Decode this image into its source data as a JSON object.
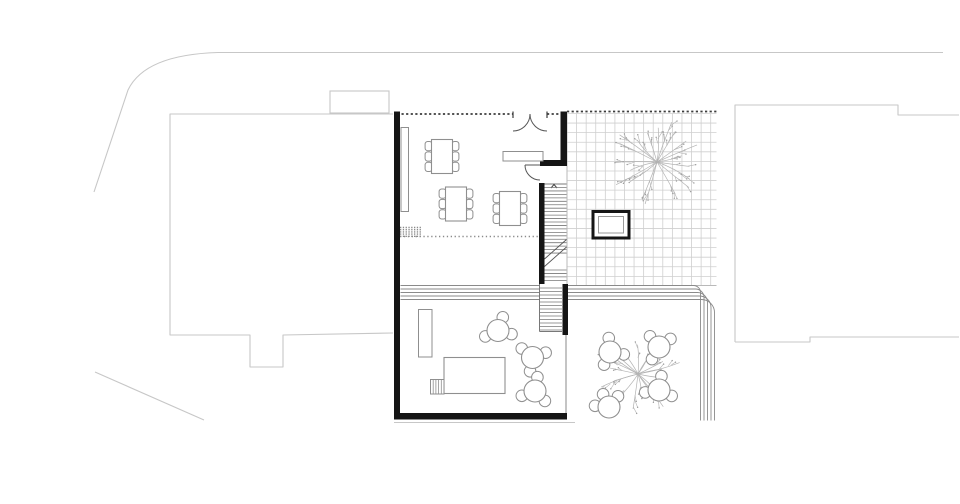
{
  "canvas": {
    "width": 960,
    "height": 504,
    "background": "#ffffff"
  },
  "colors": {
    "wall": "#151515",
    "site": "#c7c7c7",
    "grid": "#cfcfcf",
    "furniture": "#8f8f8f",
    "stair": "#787878",
    "dash_dark": "#3c3c3c",
    "dots": "#8a8a8a",
    "tree": "#b3b3b3",
    "tree_dot": "#9c9c9c",
    "step": "#8a8a8a"
  },
  "plan": {
    "site": {
      "road_paths": [
        "M 943 52.5 L 218 52.5 C 168 54 139 67 128 90 L 94 192",
        "M 95 372 L 204 420"
      ],
      "ground_line": {
        "x1": 394,
        "y1": 422.5,
        "x2": 575,
        "y2": 422.5
      },
      "neighbor_left": {
        "outline": "M 393 114 L 170 114 L 170 335 L 250 335 L 250 367 L 283 367 L 283 335 L 393 333",
        "bump": {
          "x": 330,
          "y": 91,
          "w": 59,
          "h": 22
        }
      },
      "neighbor_right": {
        "outline": "M 735 342 L 735 105 L 898 105 L 898 115 L 959 115",
        "bottom": "M 735 342 L 810 342 L 810 337 L 959 337"
      }
    },
    "walls": [
      {
        "x": 394,
        "y": 111.5,
        "w": 6,
        "h": 308
      },
      {
        "x": 394,
        "y": 413,
        "w": 173,
        "h": 6.5
      },
      {
        "x": 560.5,
        "y": 111.5,
        "w": 6.5,
        "h": 54.5
      },
      {
        "x": 540,
        "y": 160,
        "w": 26.5,
        "h": 6
      },
      {
        "x": 539,
        "y": 183,
        "w": 5.5,
        "h": 101
      },
      {
        "x": 562.5,
        "y": 284,
        "w": 5.5,
        "h": 51
      }
    ],
    "facade_dashes": [
      {
        "x1": 401.5,
        "y1": 114,
        "x2": 513,
        "y2": 114
      },
      {
        "x1": 547,
        "y1": 114,
        "x2": 560.5,
        "y2": 114
      },
      {
        "x1": 567,
        "y1": 111.5,
        "x2": 716.5,
        "y2": 111.5
      }
    ],
    "door_jambs": [
      {
        "x1": 513,
        "y1": 111.5,
        "x2": 513,
        "y2": 118
      },
      {
        "x1": 547,
        "y1": 111.5,
        "x2": 547,
        "y2": 118
      }
    ],
    "entrance_door_arcs": [
      "M 530 114 A 17 17 0 0 1 513 131",
      "M 530 114 A 17 17 0 0 0 547 131"
    ],
    "interior_door": {
      "leaf": {
        "x1": 525,
        "y1": 165,
        "x2": 540,
        "y2": 165
      },
      "arc": "M 525 165 A 15 15 0 0 0 540 180"
    },
    "grid": {
      "x": 567,
      "y": 113.5,
      "w": 149.5,
      "h": 172,
      "cell": 9.58
    },
    "skylight": {
      "outer": {
        "x": 593,
        "y": 211.5,
        "w": 36,
        "h": 26.5
      },
      "inner": {
        "x": 598.5,
        "y": 216.5,
        "w": 25,
        "h": 16.5
      }
    },
    "stairs": {
      "top_line": {
        "x1": 544.5,
        "y1": 184,
        "x2": 566.5,
        "y2": 184
      },
      "arrow": "M 551 188 L 554 184.5 L 557 188",
      "upper": {
        "x1": 544.5,
        "x2": 566.5,
        "y_from": 187.5,
        "y_to": 256,
        "step": 3.45
      },
      "mid": {
        "x1": 544.5,
        "x2": 566.5,
        "y_from": 270,
        "y_to": 282,
        "step": 3.45
      },
      "breaks": [
        {
          "x1": 544.5,
          "y1": 259,
          "x2": 566.5,
          "y2": 239.5
        },
        {
          "x1": 544.5,
          "y1": 266.5,
          "x2": 566.5,
          "y2": 247
        }
      ],
      "lower": {
        "x1": 539.5,
        "x2": 562,
        "y_from": 288,
        "y_to": 330,
        "step": 3.5
      },
      "lower_left_edge": {
        "x1": 539.5,
        "y1": 284,
        "x2": 539.5,
        "y2": 331.5
      },
      "lower_bottom": {
        "x1": 539.5,
        "y1": 331.5,
        "x2": 562,
        "y2": 331.5
      },
      "grid_edge": {
        "x1": 567,
        "y1": 113.5,
        "x2": 567,
        "y2": 285
      }
    },
    "terrace": {
      "steps_left": {
        "x1": 400.5,
        "x2": 539,
        "y_from": 285.5,
        "count": 5,
        "gap": 3.5
      },
      "steps_corner": {
        "x_start": 567,
        "y_from": 285.5,
        "count": 5,
        "gap": 3.5,
        "xv": 700.5,
        "r": 7,
        "y_end": 420.5
      },
      "right_edge": {
        "x1": 566,
        "y1": 335,
        "x2": 566,
        "y2": 413
      },
      "planter": {
        "x": 418.5,
        "y": 309.5,
        "w": 13.5,
        "h": 47.5
      },
      "big_table": {
        "x": 444,
        "y": 357.5,
        "w": 61,
        "h": 36
      },
      "hatch_step": {
        "x": 430.5,
        "y": 379.5,
        "w": 13.5,
        "h": 14.5,
        "lines": 4
      }
    },
    "bench": {
      "x": 401,
      "y": 127.5,
      "w": 7.5,
      "h": 84
    },
    "counter": {
      "x": 503,
      "y": 151.5,
      "w": 40,
      "h": 9.5
    },
    "dot_patch": {
      "x": 400,
      "y": 227.5,
      "w": 21,
      "rows": 5,
      "rgap": 2.2
    },
    "dotted_line": {
      "x1": 400,
      "y1": 236.5,
      "x2": 539,
      "y2": 236.5
    },
    "dining_tables": [
      {
        "x": 431.5,
        "y": 139.5,
        "w": 21,
        "h": 34
      },
      {
        "x": 445.5,
        "y": 187,
        "w": 21,
        "h": 34
      },
      {
        "x": 499.5,
        "y": 191.5,
        "w": 21,
        "h": 34
      }
    ],
    "chair": {
      "w": 7,
      "h": 9.2,
      "offsets": [
        2,
        12.4,
        22.8
      ]
    },
    "round_tables": [
      {
        "cx": 498,
        "cy": 330.5,
        "angles": [
          -70,
          15,
          155
        ]
      },
      {
        "cx": 532.5,
        "cy": 357.5,
        "angles": [
          -20,
          100,
          220
        ]
      },
      {
        "cx": 535,
        "cy": 391,
        "angles": [
          45,
          160,
          280
        ]
      },
      {
        "cx": 610,
        "cy": 352,
        "angles": [
          -95,
          10,
          115
        ]
      },
      {
        "cx": 659,
        "cy": 347,
        "angles": [
          -130,
          -35,
          120
        ]
      },
      {
        "cx": 659,
        "cy": 390,
        "angles": [
          -80,
          25,
          170
        ]
      },
      {
        "cx": 609,
        "cy": 407,
        "angles": [
          -115,
          -50,
          185
        ]
      }
    ],
    "round_table_r": 11,
    "chair_r": 5.8,
    "chair_dist": 14,
    "trees": [
      {
        "cx": 657,
        "cy": 162,
        "r": 48,
        "branches": 20,
        "seed": 7
      },
      {
        "cx": 638,
        "cy": 374,
        "r": 46,
        "branches": 20,
        "seed": 23
      }
    ]
  }
}
